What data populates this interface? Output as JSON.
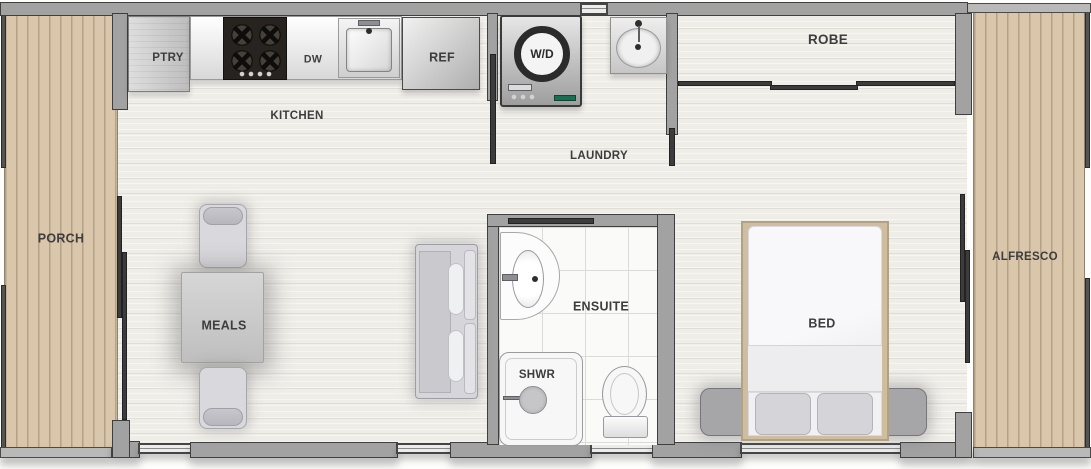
{
  "rooms": {
    "porch": "PORCH",
    "kitchen": "KITCHEN",
    "laundry": "LAUNDRY",
    "robe": "ROBE",
    "meals": "MEALS",
    "ensuite": "ENSUITE",
    "bed": "BED",
    "alfresco": "ALFRESCO"
  },
  "fixtures": {
    "pantry": "PTRY",
    "dishwasher": "DW",
    "fridge": "REF",
    "washer_dryer": "W/D",
    "shower": "SHWR"
  },
  "colors": {
    "deck": "#d9c6ab",
    "deck_line": "#b4a286",
    "wall": "#a2a2a2",
    "wall_dark": "#3f3f3f",
    "floor": "#efede8",
    "tile": "#fafaf8",
    "label": "#3d3d3d",
    "appliance_dark": "#27231f",
    "wd_green": "#1a6e52",
    "bed_frame": "#cfbd9f"
  }
}
